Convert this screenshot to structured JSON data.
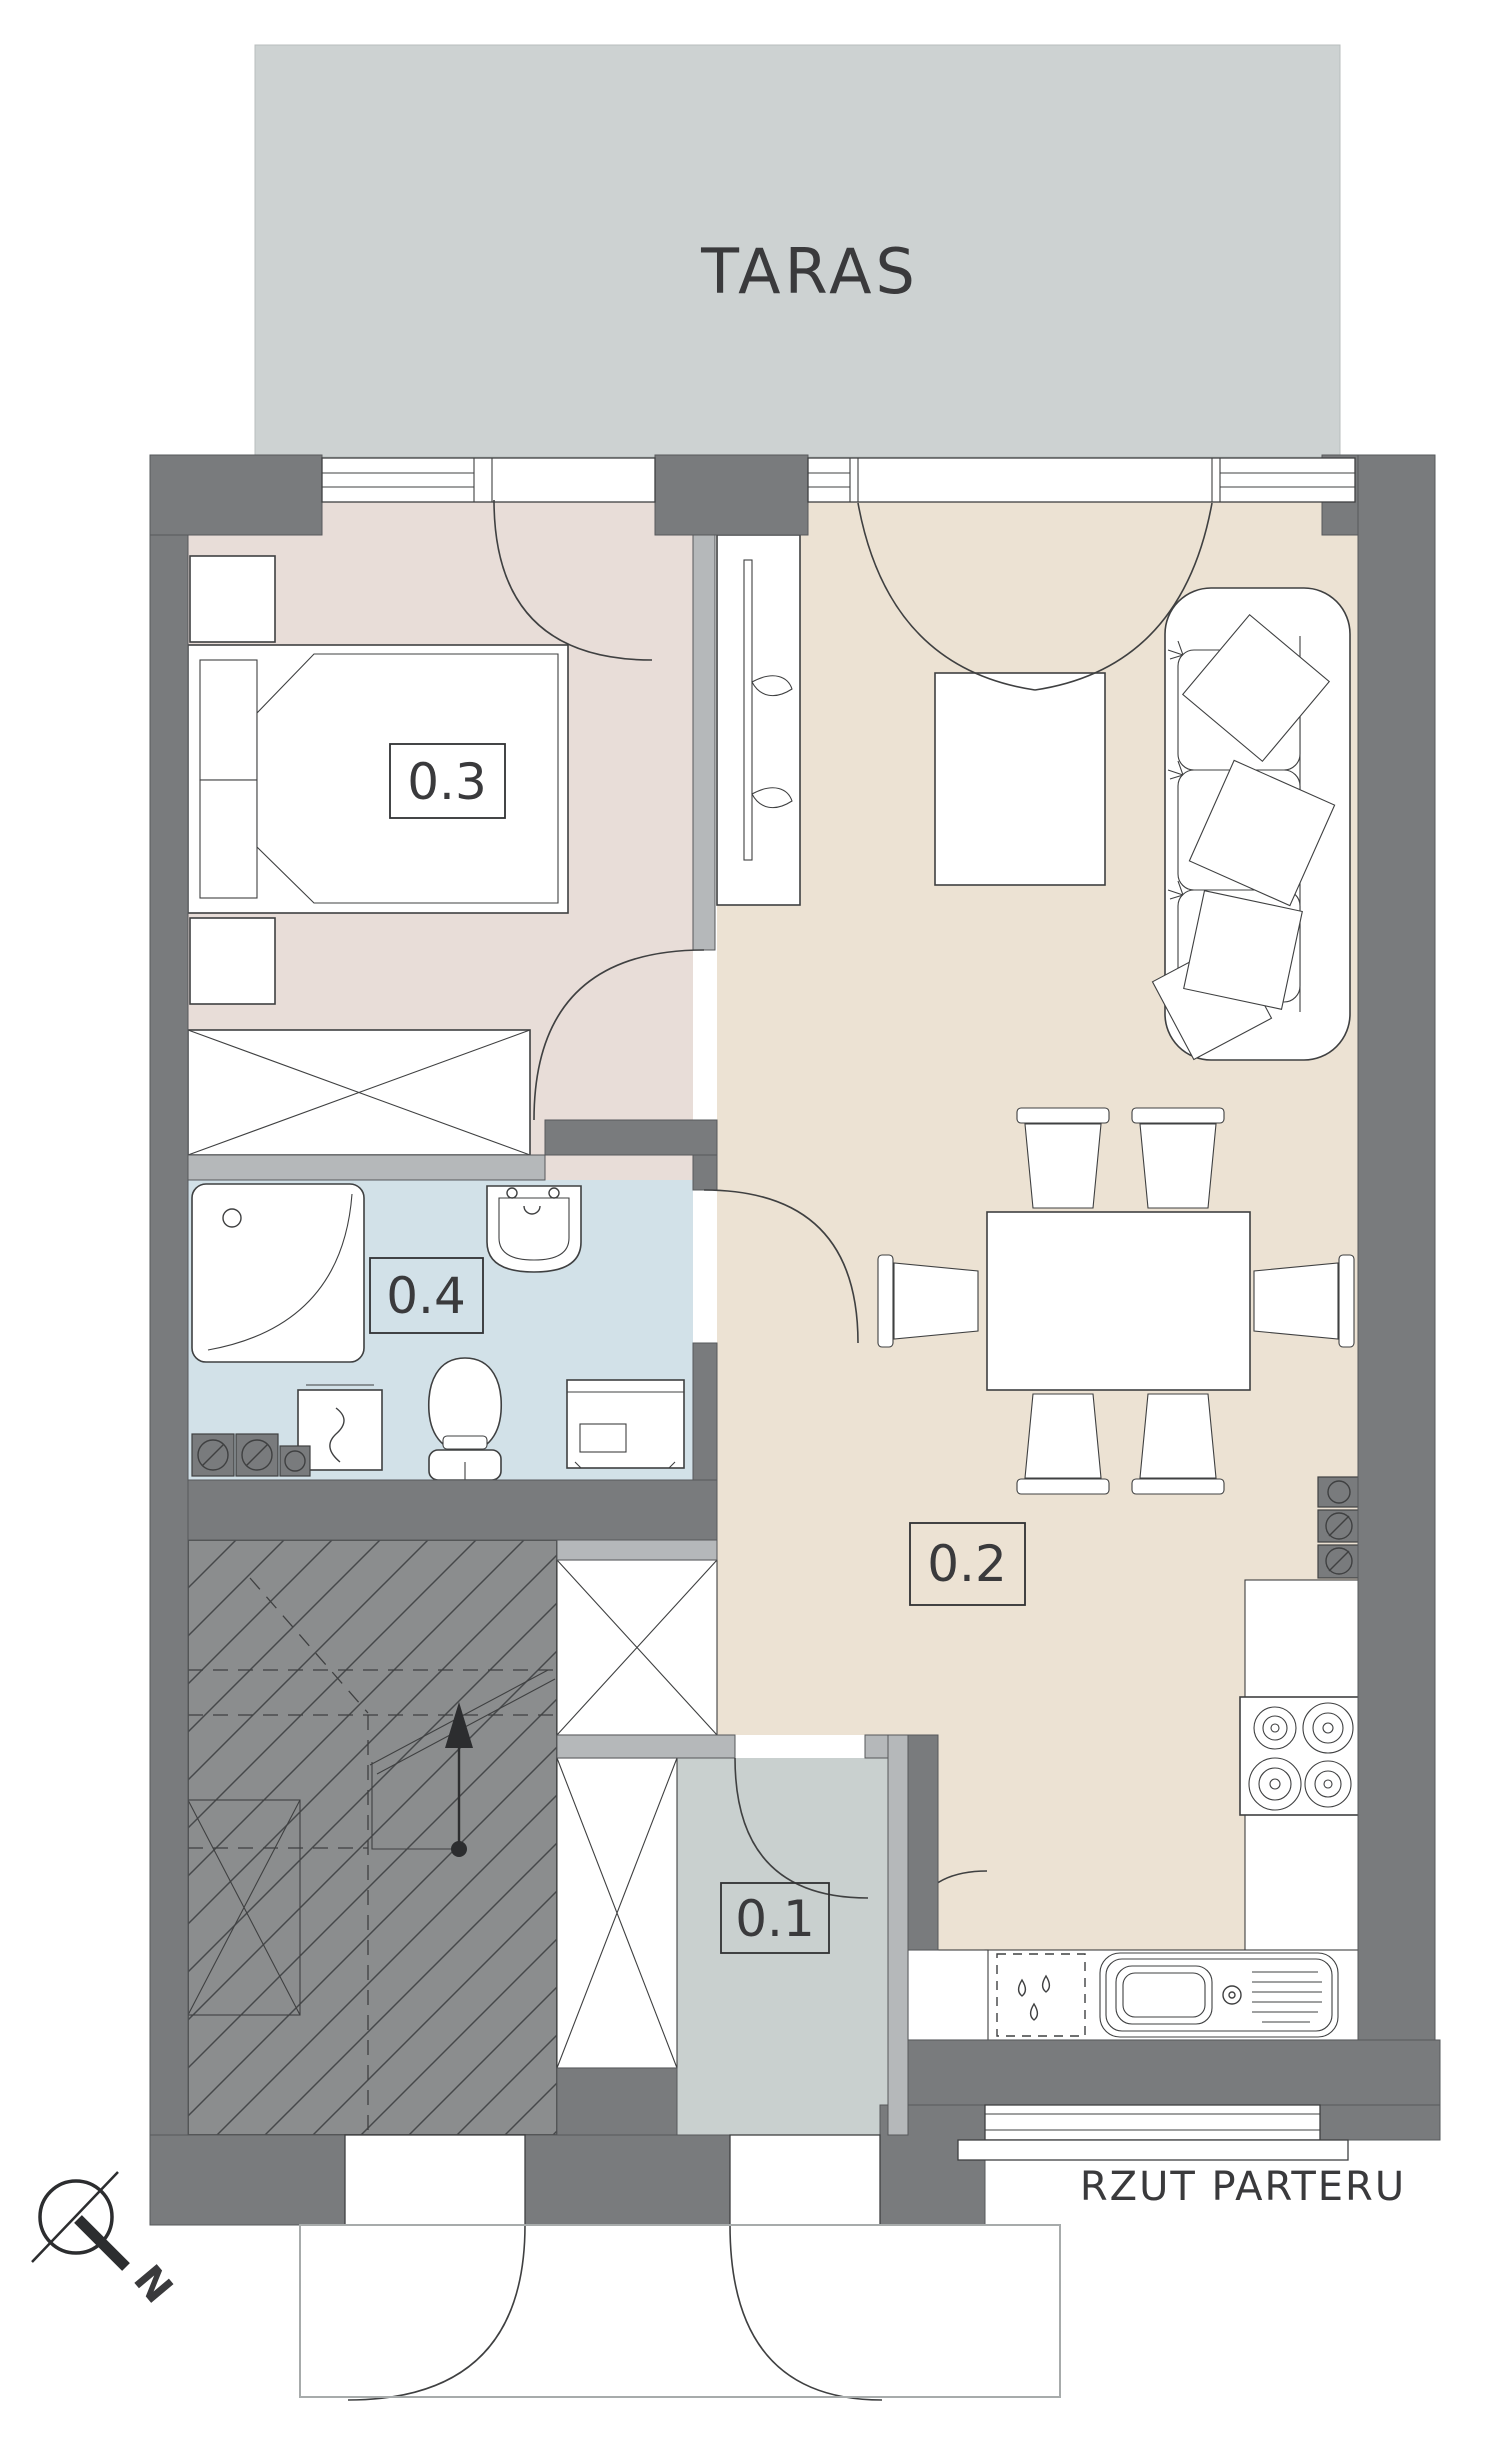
{
  "title": {
    "label": "RZUT PARTERU"
  },
  "terrace": {
    "label": "TARAS"
  },
  "rooms": [
    {
      "number": "0.1",
      "name": "entry-hall"
    },
    {
      "number": "0.2",
      "name": "living-room-with-kitchen"
    },
    {
      "number": "0.3",
      "name": "bedroom"
    },
    {
      "number": "0.4",
      "name": "bathroom"
    }
  ],
  "compass": {
    "north_label": "N"
  },
  "colors": {
    "wall": "#797b7d",
    "partition": "#b5b8ba",
    "terrace_floor": "#cdd2d2",
    "bedroom_floor": "#e8ddd8",
    "living_floor": "#ece2d3",
    "bathroom_floor": "#d2e1e8",
    "hall_floor": "#c9d0cf",
    "stairs_floor": "#8b8d8e",
    "line": "#3f4041",
    "text": "#3a3a3c"
  }
}
